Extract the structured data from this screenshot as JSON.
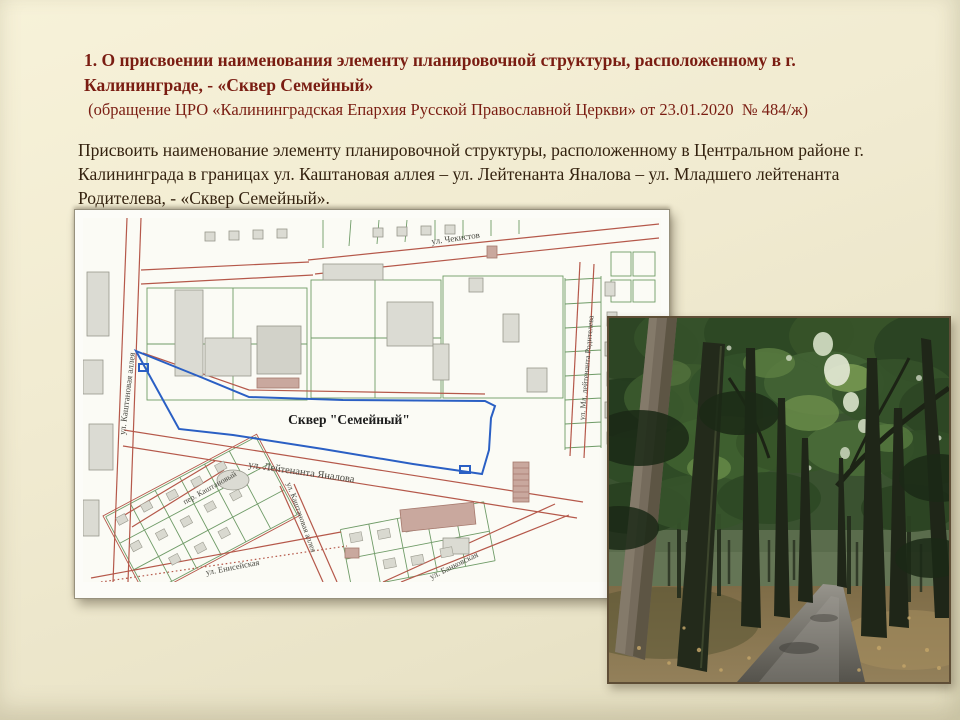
{
  "slide": {
    "title": "1. О присвоении наименования элементу планировочной структуры, расположенному в г. Калининграде, - «Сквер Семейный»",
    "subtitle": " (обращение ЦРО «Калининградская Епархия Русской Православной Церкви» от 23.01.2020  № 484/ж)",
    "body": "Присвоить наименование элементу планировочной структуры, расположенному в Центральном районе г. Калининграда в границах ул. Каштановая аллея – ул. Лейтенанта Яналова – ул. Младшего лейтенанта Родителева, - «Сквер Семейный».",
    "colors": {
      "background": "#efe9cd",
      "title_text": "#7a1d12",
      "body_text": "#34220f"
    }
  },
  "map": {
    "square_label": "Сквер \"Семейный\"",
    "streets": [
      {
        "id": "chekistov",
        "name": "ул. Чекистов"
      },
      {
        "id": "kashtanovaya-alleya-west",
        "name": "ул. Каштановая аллея"
      },
      {
        "id": "ml-leytenanta-roditeleva",
        "name": "ул. Мл. лейтенанта Родителева"
      },
      {
        "id": "leytenanta-yanalova",
        "name": "ул. Лейтенанта Яналова"
      },
      {
        "id": "per-kashtanovyy",
        "name": "пер. Каштановый"
      },
      {
        "id": "kashtanovaya-alleya-south",
        "name": "ул. Каштановая аллея"
      },
      {
        "id": "eniseyskaya",
        "name": "ул. Енисейская"
      },
      {
        "id": "bankovskaya",
        "name": "ул. Банковская"
      }
    ],
    "colors": {
      "boundary_blue": "#2a5fc4",
      "road_red": "#b5584a",
      "parcel_green": "#6f9b67",
      "building_gray": "#dbdbd3",
      "building_salmon": "#c9a89e",
      "paper": "#fcfcf8"
    }
  }
}
